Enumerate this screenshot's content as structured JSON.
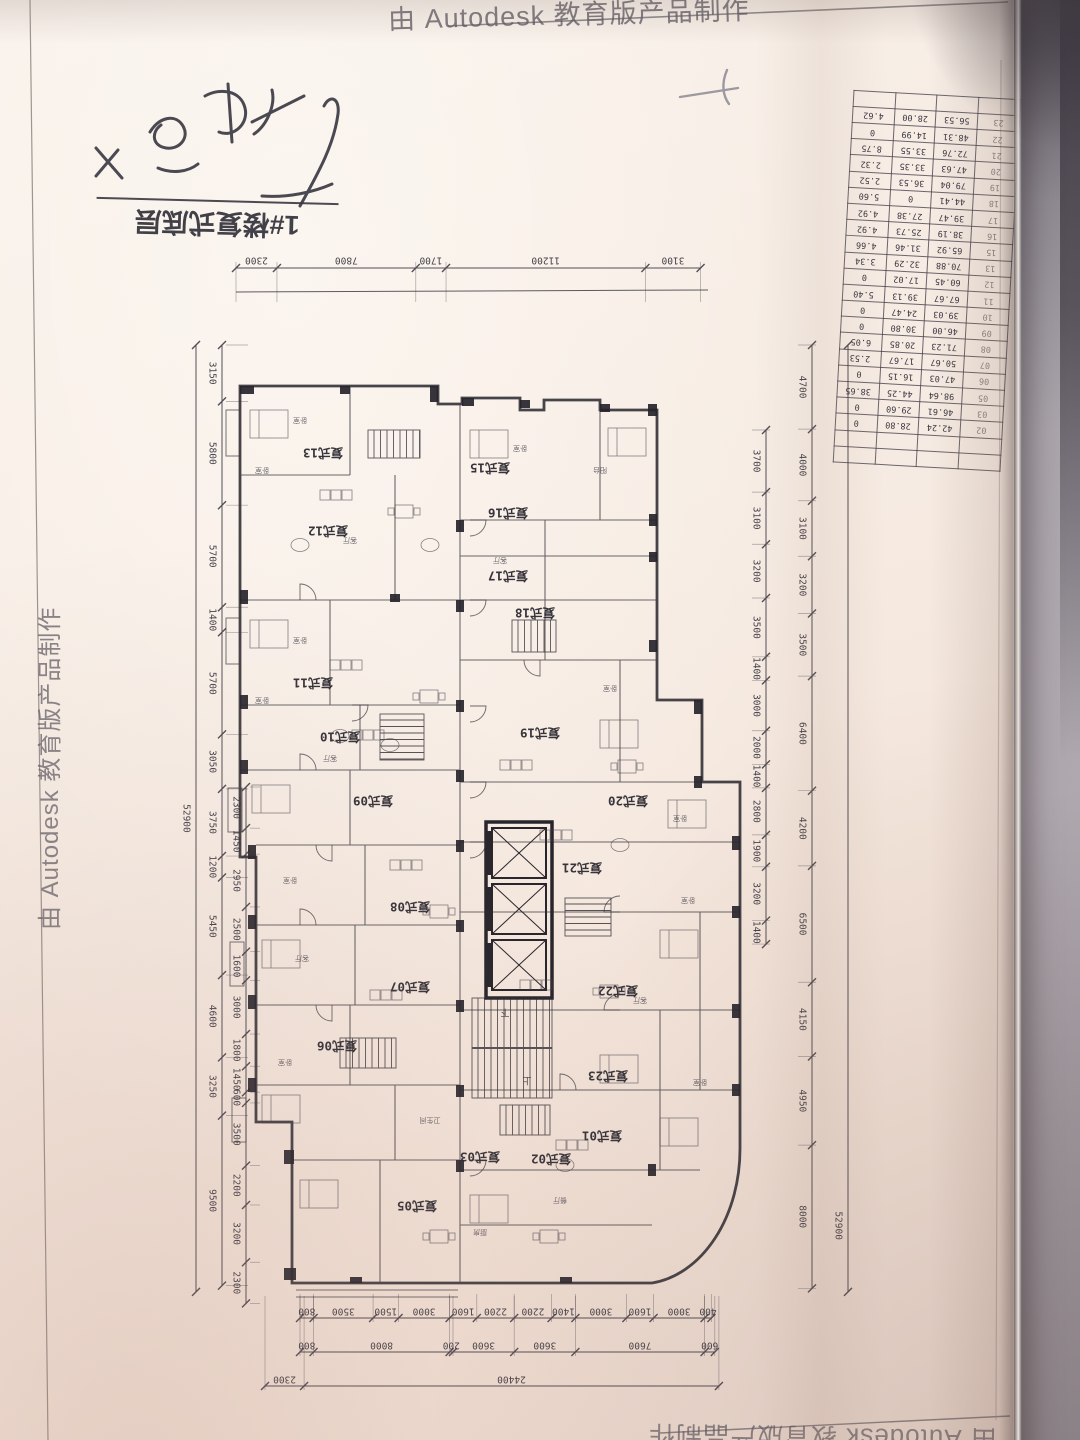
{
  "watermark": {
    "text": "由 Autodesk 教育版产品制作"
  },
  "title_block": {
    "label": "1#楼复式底层"
  },
  "plan": {
    "unit_type_prefix": "复式",
    "units": [
      "01",
      "02",
      "03",
      "05",
      "06",
      "07",
      "08",
      "09",
      "10",
      "11",
      "12",
      "13",
      "15",
      "16",
      "17",
      "18",
      "19",
      "20",
      "21",
      "22",
      "23"
    ],
    "stair_up": "上",
    "stair_down": "下",
    "room_labels": [
      "卧室",
      "客厅",
      "餐厅",
      "厨房",
      "阳台",
      "卫生间"
    ],
    "dims": {
      "top": [
        "2300",
        "7800",
        "1700",
        "11200",
        "3100"
      ],
      "left_total": [
        "52900"
      ],
      "left_middle": [
        "3150",
        "5800",
        "5700",
        "1400",
        "5700",
        "3050",
        "3750",
        "1200",
        "5450",
        "4600",
        "3250",
        "9500"
      ],
      "left_inner": [
        "2300",
        "1450",
        "2950",
        "2500",
        "1600",
        "3000",
        "1800",
        "1450",
        "600",
        "3500",
        "2200",
        "3200",
        "2300"
      ],
      "right_inner": [
        "3700",
        "3100",
        "3200",
        "3500",
        "1400",
        "3000",
        "2000",
        "1400",
        "2800",
        "1900",
        "3200",
        "1400"
      ],
      "right_outer": [
        "4700",
        "4000",
        "3100",
        "3200",
        "3500",
        "6400",
        "4200",
        "6500",
        "4150",
        "4950",
        "8000"
      ],
      "right_total": [
        "52900"
      ],
      "bottom_inner": [
        "800",
        "3500",
        "1500",
        "3000",
        "1600",
        "2200",
        "2200",
        "1400",
        "3000",
        "1600",
        "3000",
        "400"
      ],
      "bottom_middle": [
        "800",
        "8000",
        "200",
        "3600",
        "3600",
        "7600",
        "600"
      ],
      "bottom_outer": [
        "2300",
        "24400"
      ]
    }
  },
  "area_table": {
    "rows": [
      [
        "02",
        "42.24",
        "28.80",
        "0"
      ],
      [
        "03",
        "46.61",
        "29.60",
        "0"
      ],
      [
        "05",
        "98.64",
        "44.25",
        "38.65"
      ],
      [
        "06",
        "47.03",
        "16.15",
        "0"
      ],
      [
        "07",
        "50.67",
        "17.67",
        "2.53"
      ],
      [
        "08",
        "71.23",
        "20.85",
        "6.05"
      ],
      [
        "09",
        "46.00",
        "30.80",
        "0"
      ],
      [
        "10",
        "39.03",
        "24.47",
        "0"
      ],
      [
        "11",
        "67.67",
        "39.13",
        "5.40"
      ],
      [
        "12",
        "60.45",
        "17.02",
        "0"
      ],
      [
        "13",
        "70.88",
        "32.29",
        "3.34"
      ],
      [
        "15",
        "65.92",
        "31.46",
        "4.66"
      ],
      [
        "16",
        "38.19",
        "25.73",
        "4.92"
      ],
      [
        "17",
        "39.47",
        "27.38",
        "4.92"
      ],
      [
        "18",
        "44.41",
        "0",
        "5.60"
      ],
      [
        "19",
        "79.04",
        "36.53",
        "2.52"
      ],
      [
        "20",
        "47.63",
        "33.35",
        "2.32"
      ],
      [
        "21",
        "72.76",
        "33.55",
        "8.75"
      ],
      [
        "22",
        "48.31",
        "14.99",
        "0"
      ],
      [
        "23",
        "56.53",
        "28.00",
        "4.62"
      ]
    ]
  },
  "colors": {
    "paper": "#f6ebe2",
    "ink": "#2e2c33",
    "backdrop": "#a29da3",
    "edge_shadow": "#5c5760"
  }
}
